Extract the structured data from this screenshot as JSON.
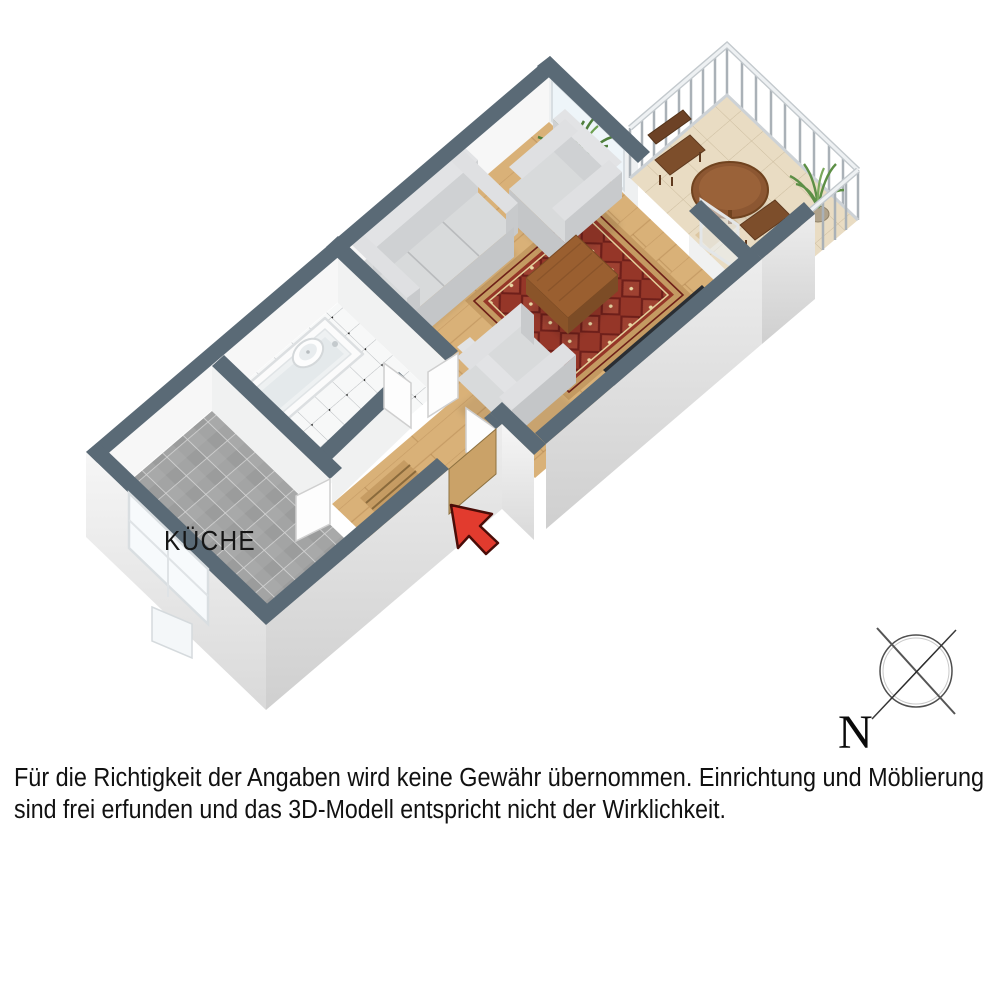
{
  "floor_plan": {
    "room_labels": {
      "kitchen": "KÜCHE"
    },
    "compass": {
      "north_label": "N"
    },
    "disclaimer": {
      "line1": "Für die Richtigkeit der Angaben wird keine Gewähr übernommen. Einrichtung und Möblierung",
      "line2": "sind frei erfunden und das 3D-Modell entspricht nicht der Wirklichkeit."
    },
    "colors": {
      "background": "#ffffff",
      "wall_top": "#5a6a76",
      "wall_face_light": "#f2f2f2",
      "wall_face_dark": "#e6e6e6",
      "wood_floor": "#d9b178",
      "kitchen_tile": "#a3a4a4",
      "bath_tile": "#f7f8f8",
      "balcony_floor": "#e9dcc3",
      "rug_red": "#953628",
      "rug_border": "#c49a62",
      "sofa_gray": "#d8dadb",
      "table_wood": "#9a5f30",
      "radiator_dark": "#2a2e33",
      "arrow_red": "#e23b2e",
      "text_color": "#161616"
    }
  }
}
